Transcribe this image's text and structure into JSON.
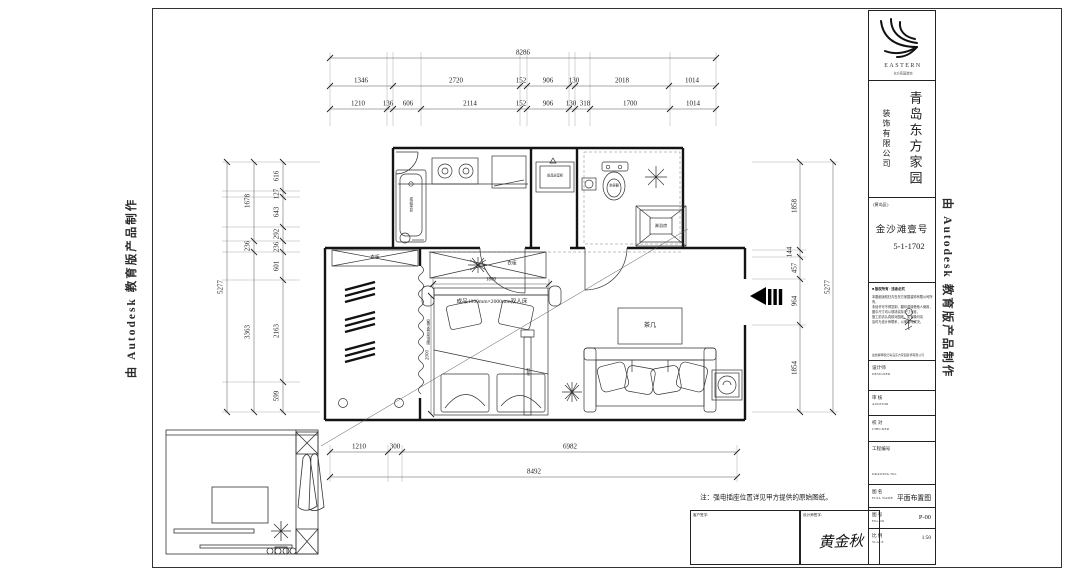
{
  "watermark_text": "由 Autodesk 教育版产品制作",
  "dims": {
    "top_total": "8286",
    "top_row2": [
      "1346",
      "2720",
      "152",
      "906",
      "130",
      "2018",
      "1014"
    ],
    "top_row3": [
      "1210",
      "136",
      "606",
      "2114",
      "152",
      "906",
      "130",
      "318",
      "1700",
      "1014"
    ],
    "left_total": "5277",
    "left_mid": [
      "1678",
      "236",
      "3363"
    ],
    "left_inner": [
      "616",
      "127",
      "643",
      "292",
      "236",
      "601",
      "2163",
      "599"
    ],
    "right_total": "5277",
    "right_inner": [
      "1858",
      "144",
      "457",
      "964",
      "1854"
    ],
    "bottom_row": [
      "1210",
      "300",
      "6982"
    ],
    "bottom_total": "8492",
    "bed_width": "1800",
    "bed_depth": "2000"
  },
  "plan": {
    "bed_label": "成品1800mm×2000mm双人床",
    "coffee_table": "茶几",
    "cabinet_left": "衣柜",
    "cabinet_top": "衣柜",
    "sink": "成品菜盆",
    "vanity": "成品浴室柜",
    "toilet": "坐便器",
    "shower": "淋浴房",
    "curtain": "窗帘盒见吊顶图",
    "screen": "鞋柜"
  },
  "footer": {
    "note": "注：强电插座位置详见甲方提供的原始图纸。",
    "client_label": "客户签字:",
    "designer_label": "设计师签字:",
    "designer_name": "黄金秋"
  },
  "title_block": {
    "logo_text": "EASTERN",
    "logo_sub": "东方家园装饰",
    "company_main": "青岛东方家园",
    "company_sub": "装饰有限公司",
    "project_region": "(黄岛区)",
    "project_name": "金沙滩壹号",
    "project_no": "5-1-1702",
    "disclaimer_title": "■ 版权所有 · 违者必究",
    "disclaimer_lines": [
      "本图纸版权归青岛东方家园装饰有限公司所有，",
      "未经许可不得复制、翻印或转借他人使用，",
      "图中尺寸均以现场实际尺寸为准，",
      "施工前请认真核对图纸，如有疑问请",
      "及时与设计师联系，以便及时解决。"
    ],
    "copyright_line": "最终解释权归青岛东方家园装饰有限公司",
    "rows": [
      {
        "cn": "设计师",
        "en": "DESIGNER",
        "value": ""
      },
      {
        "cn": "审  核",
        "en": "AUDITOR",
        "value": ""
      },
      {
        "cn": "校  对",
        "en": "CHECKER",
        "value": ""
      },
      {
        "cn": "工程编号",
        "en": "DRAWING NO.",
        "value": ""
      },
      {
        "cn": "图  名",
        "en": "FULL NAME",
        "value": "平面布置图"
      },
      {
        "cn": "图  号",
        "en": "FIG.NO",
        "value": "P-00"
      },
      {
        "cn": "比  例",
        "en": "SCALE",
        "value": "1:50"
      }
    ]
  }
}
